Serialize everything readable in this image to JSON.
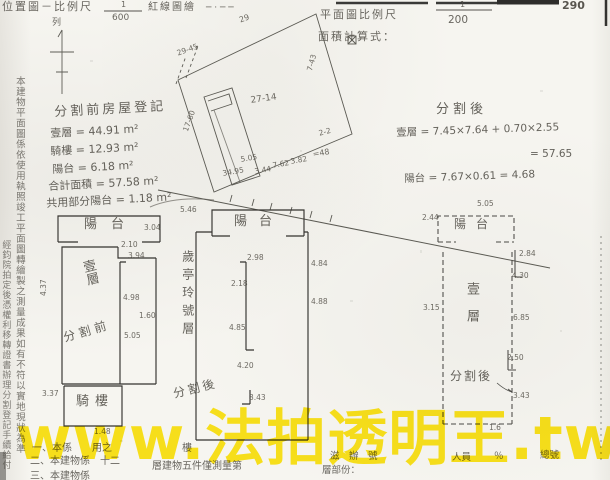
{
  "document": {
    "type_note": "建物分割測量成果圖(掃描件)",
    "watermark": {
      "text": "www.法拍透明王.tw",
      "color": "#ffe50a"
    }
  },
  "labels": [
    {
      "name": "doc-title-left",
      "text": "位置圖－比例尺",
      "x": 2,
      "y": 1,
      "size": 11,
      "ls": 2,
      "cls": "print"
    },
    {
      "name": "scale-left-numerator",
      "text": "1",
      "x": 121,
      "y": 0,
      "size": 8,
      "cls": "print"
    },
    {
      "name": "scale-left-denominator",
      "text": "600",
      "x": 112,
      "y": 13,
      "size": 9,
      "cls": "print"
    },
    {
      "name": "doc-title-left-suffix",
      "text": "紅線圖繪",
      "x": 148,
      "y": 2,
      "size": 10,
      "ls": 2,
      "cls": "print"
    },
    {
      "name": "header-artifact",
      "text": "─ · ─ ─",
      "x": 206,
      "y": 3,
      "size": 9,
      "cls": "print"
    },
    {
      "name": "north-label",
      "text": "列",
      "x": 52,
      "y": 18,
      "size": 9,
      "cls": "print"
    },
    {
      "name": "doc-title-right",
      "text": "平面圖比例尺",
      "x": 320,
      "y": 9,
      "size": 11,
      "ls": 2,
      "cls": "print"
    },
    {
      "name": "scale-right-numerator",
      "text": "1",
      "x": 460,
      "y": 0,
      "size": 8,
      "cls": "print"
    },
    {
      "name": "scale-right-denominator",
      "text": "200",
      "x": 448,
      "y": 14,
      "size": 10.5,
      "cls": "print"
    },
    {
      "name": "area-calc-label",
      "text": "面積計算式：",
      "x": 318,
      "y": 31,
      "size": 11,
      "ls": 2,
      "cls": "print"
    },
    {
      "name": "page-number",
      "text": "290",
      "x": 562,
      "y": 0,
      "size": 11,
      "cls": "bold"
    },
    {
      "name": "before-division-title",
      "text": "分割前房屋登記",
      "x": 54,
      "y": 106,
      "size": 13,
      "rot": -3,
      "ls": 3,
      "cls": "hand"
    },
    {
      "name": "before-line",
      "text": "壹層 = 44.91 m²",
      "x": 50,
      "y": 128,
      "size": 11,
      "rot": -3,
      "cls": "hand"
    },
    {
      "name": "before-line",
      "text": "騎樓 = 12.93 m²",
      "x": 50,
      "y": 146,
      "size": 11,
      "rot": -3,
      "cls": "hand"
    },
    {
      "name": "before-line",
      "text": "陽台 = 6.18 m²",
      "x": 52,
      "y": 164,
      "size": 11,
      "rot": -3,
      "cls": "hand"
    },
    {
      "name": "before-line",
      "text": "合計面積 = 57.58 m²",
      "x": 48,
      "y": 181,
      "size": 11,
      "rot": -3,
      "cls": "hand"
    },
    {
      "name": "before-line",
      "text": "共用部分陽台 = 1.18 m²",
      "x": 46,
      "y": 198,
      "size": 11,
      "rot": -3,
      "cls": "hand"
    },
    {
      "name": "after-division-title",
      "text": "分割後",
      "x": 436,
      "y": 103,
      "size": 13,
      "ls": 4,
      "cls": "hand"
    },
    {
      "name": "after-line",
      "text": "壹層 = 7.45×7.64 + 0.70×2.55",
      "x": 396,
      "y": 127,
      "size": 10.5,
      "rot": -2,
      "cls": "hand"
    },
    {
      "name": "after-line",
      "text": "= 57.65",
      "x": 530,
      "y": 148,
      "size": 10.5,
      "cls": "hand"
    },
    {
      "name": "after-line",
      "text": "陽台 = 7.67×0.61 = 4.68",
      "x": 404,
      "y": 173,
      "size": 10.5,
      "rot": -2,
      "cls": "hand"
    },
    {
      "name": "left-plan-balcony-label",
      "text": "陽台",
      "x": 84,
      "y": 218,
      "size": 13,
      "ls": 14,
      "cls": "hand"
    },
    {
      "name": "left-plan-floor-label",
      "text": "壹層",
      "x": 78,
      "y": 262,
      "size": 13,
      "rot": -14,
      "cls": "hand vsm"
    },
    {
      "name": "left-plan-division-tag",
      "text": "分割前",
      "x": 62,
      "y": 332,
      "size": 12,
      "rot": -16,
      "ls": 4,
      "cls": "hand"
    },
    {
      "name": "left-plan-arcade-label",
      "text": "騎樓",
      "x": 76,
      "y": 395,
      "size": 13,
      "ls": 6,
      "cls": "hand"
    },
    {
      "name": "middle-plan-balcony-label",
      "text": "陽台",
      "x": 234,
      "y": 215,
      "size": 13,
      "ls": 12,
      "cls": "hand"
    },
    {
      "name": "middle-plan-side-label",
      "text": "歲亭玲號層",
      "x": 180,
      "y": 250,
      "size": 12,
      "cls": "hand vcolS"
    },
    {
      "name": "middle-plan-division-tag",
      "text": "分割後",
      "x": 172,
      "y": 388,
      "size": 12,
      "rot": -14,
      "ls": 3,
      "cls": "hand"
    },
    {
      "name": "right-plan-balcony-label",
      "text": "陽台",
      "x": 454,
      "y": 218,
      "size": 12,
      "ls": 10,
      "cls": "hand"
    },
    {
      "name": "right-plan-floor-label",
      "text": "壹層",
      "x": 463,
      "y": 282,
      "size": 13,
      "cls": "hand vsm2"
    },
    {
      "name": "right-plan-division-tag",
      "text": "分割後",
      "x": 450,
      "y": 370,
      "size": 12,
      "ls": 2,
      "cls": "hand"
    },
    {
      "name": "margin-note-column-a",
      "text": "本建物平面圖係依使用執照竣工平面圖轉繪製之測量成果如有不符以實地現狀為準",
      "x": 13,
      "y": 76,
      "size": 9.5,
      "cls": "hand vcolA"
    },
    {
      "name": "margin-note-column-b",
      "text": "經鈞院拍定後憑權利移轉證書辦理分割登記手續給付",
      "x": 0,
      "y": 240,
      "size": 9,
      "cls": "hand vcolB"
    },
    {
      "name": "footer-note",
      "text": "一、本係　　用之　　　　　　　樓",
      "x": 32,
      "y": 443,
      "size": 10,
      "cls": "print"
    },
    {
      "name": "footer-note",
      "text": "二、本建物係　十二",
      "x": 30,
      "y": 456,
      "size": 10,
      "cls": "print"
    },
    {
      "name": "footer-note",
      "text": "層建物五件僅測量第",
      "x": 152,
      "y": 461,
      "size": 10,
      "cls": "print"
    },
    {
      "name": "footer-note",
      "text": "三、本建物係",
      "x": 30,
      "y": 471,
      "size": 10,
      "cls": "print"
    },
    {
      "name": "footer-field",
      "text": "滋　辦　號",
      "x": 330,
      "y": 452,
      "size": 9.5,
      "cls": "print"
    },
    {
      "name": "footer-field",
      "text": "人員",
      "x": 452,
      "y": 453,
      "size": 9.5,
      "cls": "print"
    },
    {
      "name": "footer-field",
      "text": "％",
      "x": 494,
      "y": 452,
      "size": 9.5,
      "cls": "print"
    },
    {
      "name": "footer-field",
      "text": "總號",
      "x": 540,
      "y": 451,
      "size": 9.5,
      "cls": "print"
    },
    {
      "name": "footer-field",
      "text": "層部份：",
      "x": 322,
      "y": 466,
      "size": 9.5,
      "cls": "print"
    }
  ],
  "annotations": [
    {
      "name": "site-dim",
      "text": "29",
      "x": 238,
      "y": 16,
      "rot": -20
    },
    {
      "name": "site-dim",
      "text": "29-45",
      "x": 176,
      "y": 50,
      "rot": -20,
      "size": 7.5
    },
    {
      "name": "site-parcel-number",
      "text": "27-14",
      "x": 250,
      "y": 96,
      "rot": -8,
      "size": 9
    },
    {
      "name": "site-dim",
      "text": "17-60",
      "x": 182,
      "y": 130,
      "rot": -70,
      "size": 7.5
    },
    {
      "name": "site-dim",
      "text": "7-43",
      "x": 306,
      "y": 70,
      "rot": -75,
      "size": 7.5
    },
    {
      "name": "site-dim",
      "text": "2-2",
      "x": 318,
      "y": 130,
      "rot": -15,
      "size": 7.5
    },
    {
      "name": "site-dim",
      "text": "34.95",
      "x": 222,
      "y": 170,
      "rot": -10,
      "size": 7.5
    },
    {
      "name": "site-dim",
      "text": "3.44",
      "x": 254,
      "y": 168,
      "rot": -10,
      "size": 7.5
    },
    {
      "name": "site-dim",
      "text": "5.05",
      "x": 240,
      "y": 156,
      "rot": -10,
      "size": 7.5
    },
    {
      "name": "site-dim",
      "text": "7.62",
      "x": 272,
      "y": 162,
      "rot": -10,
      "size": 7.5
    },
    {
      "name": "site-dim",
      "text": "3.82",
      "x": 290,
      "y": 158,
      "rot": -10,
      "size": 7.5
    },
    {
      "name": "site-dim",
      "text": "=48",
      "x": 312,
      "y": 150,
      "rot": -10
    },
    {
      "name": "plan-dim",
      "text": "3.94",
      "x": 128,
      "y": 252,
      "size": 7.5
    },
    {
      "name": "plan-dim",
      "text": "2.10",
      "x": 121,
      "y": 241,
      "size": 7.5
    },
    {
      "name": "plan-dim",
      "text": "4.98",
      "x": 123,
      "y": 294,
      "size": 7.5
    },
    {
      "name": "plan-dim",
      "text": "1.60",
      "x": 139,
      "y": 312,
      "size": 7.5
    },
    {
      "name": "plan-dim",
      "text": "5.05",
      "x": 124,
      "y": 332,
      "size": 7.5
    },
    {
      "name": "plan-dim",
      "text": "4.37",
      "x": 40,
      "y": 296,
      "rot": -90,
      "size": 7.5
    },
    {
      "name": "plan-dim",
      "text": "3.37",
      "x": 42,
      "y": 390,
      "size": 7.5
    },
    {
      "name": "plan-dim",
      "text": "1.48",
      "x": 94,
      "y": 428,
      "size": 7.5
    },
    {
      "name": "plan-dim",
      "text": "5.46",
      "x": 180,
      "y": 206,
      "size": 7.5
    },
    {
      "name": "plan-dim",
      "text": "3.04",
      "x": 144,
      "y": 224,
      "size": 7.5
    },
    {
      "name": "plan-dim",
      "text": "2.98",
      "x": 247,
      "y": 254,
      "size": 7.5
    },
    {
      "name": "plan-dim",
      "text": "2.18",
      "x": 231,
      "y": 280,
      "size": 7.5
    },
    {
      "name": "plan-dim",
      "text": "4.85",
      "x": 229,
      "y": 324,
      "size": 7.5
    },
    {
      "name": "plan-dim",
      "text": "4.20",
      "x": 237,
      "y": 362,
      "size": 7.5
    },
    {
      "name": "plan-dim",
      "text": "3.43",
      "x": 249,
      "y": 394,
      "size": 7.5
    },
    {
      "name": "plan-dim",
      "text": "4.84",
      "x": 311,
      "y": 260,
      "size": 7.5
    },
    {
      "name": "plan-dim",
      "text": "4.88",
      "x": 311,
      "y": 298,
      "size": 7.5
    },
    {
      "name": "plan-dim",
      "text": "5.05",
      "x": 477,
      "y": 200,
      "size": 7.5
    },
    {
      "name": "plan-dim",
      "text": "2.44",
      "x": 422,
      "y": 214,
      "size": 7.5
    },
    {
      "name": "plan-dim",
      "text": "2.84",
      "x": 519,
      "y": 250,
      "size": 7.5
    },
    {
      "name": "plan-dim",
      "text": "4.30",
      "x": 512,
      "y": 272,
      "size": 7.5
    },
    {
      "name": "plan-dim",
      "text": "3.15",
      "x": 423,
      "y": 304,
      "size": 7.5
    },
    {
      "name": "plan-dim",
      "text": "6.85",
      "x": 513,
      "y": 314,
      "size": 7.5
    },
    {
      "name": "plan-dim",
      "text": "2.50",
      "x": 507,
      "y": 354,
      "size": 7.5
    },
    {
      "name": "plan-dim",
      "text": "3.43",
      "x": 513,
      "y": 392,
      "size": 7.5
    },
    {
      "name": "plan-dim",
      "text": "1.6",
      "x": 489,
      "y": 424,
      "size": 7.5
    }
  ]
}
